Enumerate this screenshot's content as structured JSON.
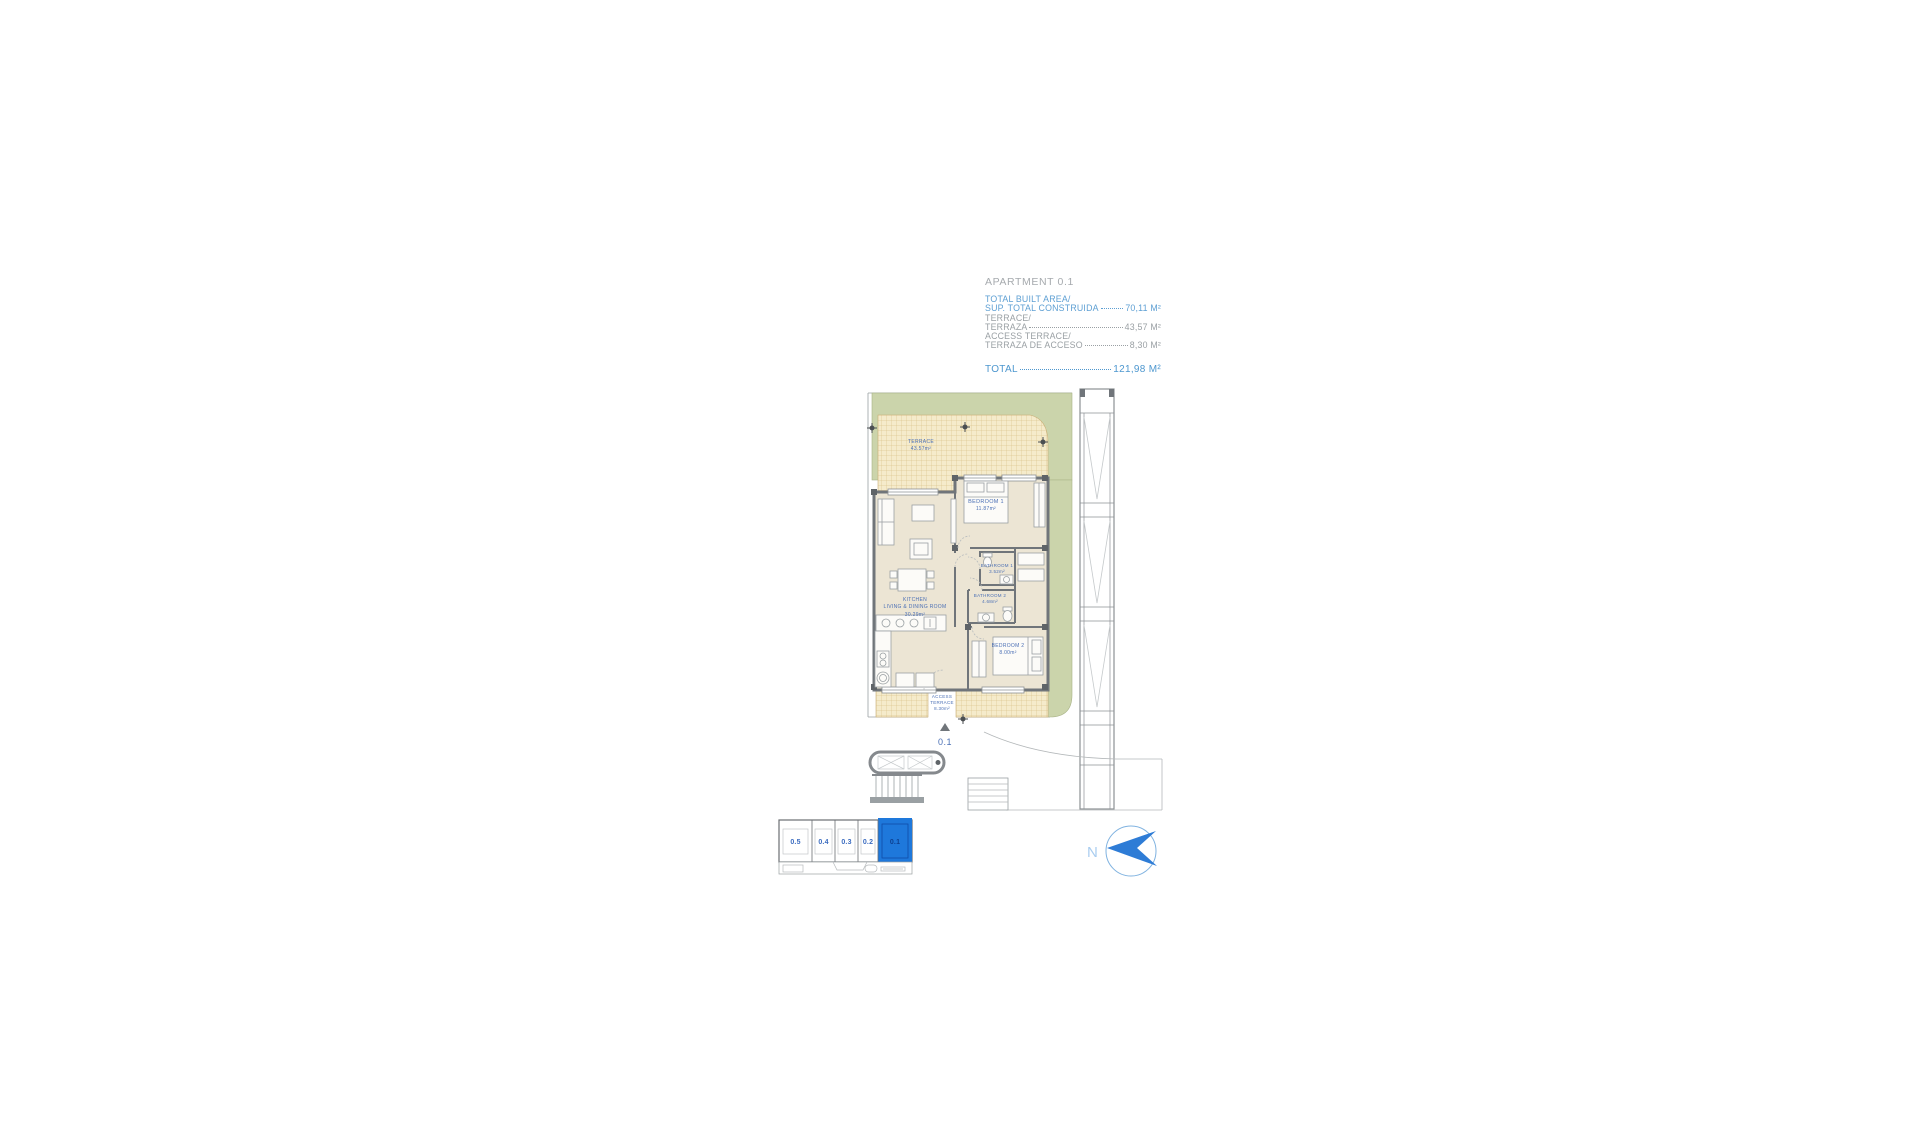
{
  "summary": {
    "title": "APARTMENT 0.1",
    "entries": [
      {
        "line1": "TOTAL BUILT AREA/",
        "line2": "SUP. TOTAL CONSTRUIDA",
        "value": "70,11 M²",
        "style": "blue"
      },
      {
        "line1": "TERRACE/",
        "line2": "TERRAZA",
        "value": "43,57 M²",
        "style": "gray"
      },
      {
        "line1": "ACCESS TERRACE/",
        "line2": "TERRAZA DE ACCESO",
        "value": "8,30 M²",
        "style": "gray"
      }
    ],
    "total": {
      "label": "TOTAL ",
      "value": "121,98 M²"
    }
  },
  "plan": {
    "terrace": {
      "name": "TERRACE",
      "area": "43.57m²"
    },
    "bedroom1": {
      "name": "BEDROOM 1",
      "area": "11.87m²"
    },
    "bathroom1": {
      "name": "BATHROOM 1",
      "area": "3.52m²"
    },
    "bathroom2": {
      "name": "BATHROOM 2",
      "area": "4.68m²"
    },
    "bedroom2": {
      "name": "BEDROOM 2",
      "area": "8.00m²"
    },
    "kitchen": {
      "name": "KITCHEN",
      "name2": "LIVING & DINING ROOM",
      "area": "30.29m²"
    },
    "access_terrace": {
      "name": "ACCESS",
      "name2": "TERRACE",
      "area": "8.30m²"
    },
    "entrance_label": "0.1"
  },
  "keyplan": {
    "units": [
      "0.5",
      "0.4",
      "0.3",
      "0.2",
      "0.1"
    ],
    "highlighted": "0.1"
  },
  "compass": {
    "label": "N"
  },
  "colors": {
    "accent_blue": "#5d9fd3",
    "gray_text": "#9aa0a4",
    "plan_label_blue": "#4a6fb5",
    "highlight_blue": "#1e78db",
    "terrace_green": "#cbd4ab",
    "floor_beige": "#ece5d4",
    "hatch_fill": "#f5ebcb",
    "wall_gray": "#70757a"
  }
}
